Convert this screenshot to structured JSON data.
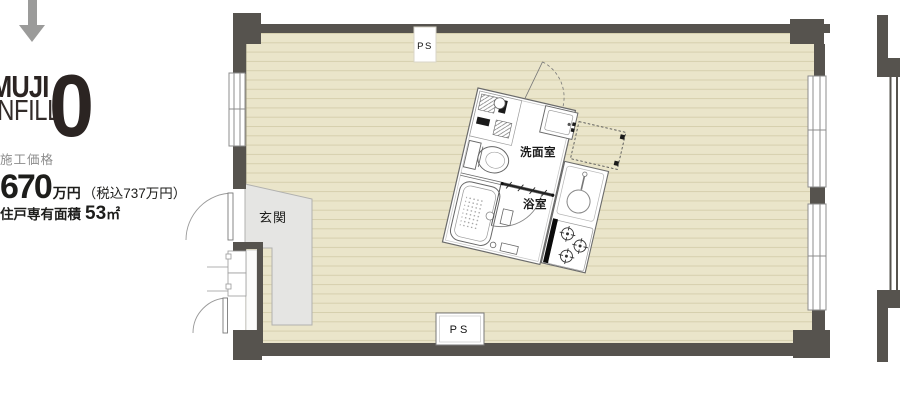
{
  "left_panel": {
    "logo_line1": "MUJI",
    "logo_line2": "INFILL",
    "logo_number": "0",
    "price_label": "施工価格",
    "price_amount": "670",
    "price_amount_unit": "万円",
    "price_tax": "（税込737万円）",
    "area_label": "住戸専有面積",
    "area_value": "53",
    "area_unit": "㎡"
  },
  "floor_plan": {
    "labels": {
      "ps_top": "PS",
      "ps_bottom": "PS",
      "entrance": "玄関",
      "washroom": "洗面室",
      "bathroom": "浴室"
    },
    "colors": {
      "floor": "#eae5ca",
      "floor_stripe": "#d6cfae",
      "wall": "#56534e",
      "entrance_fill": "#e5e5e3",
      "unit_fill": "#ffffff",
      "outline": "#8c8c8c",
      "arrow": "#9b9b9a",
      "text": "#1d1d1b"
    }
  }
}
